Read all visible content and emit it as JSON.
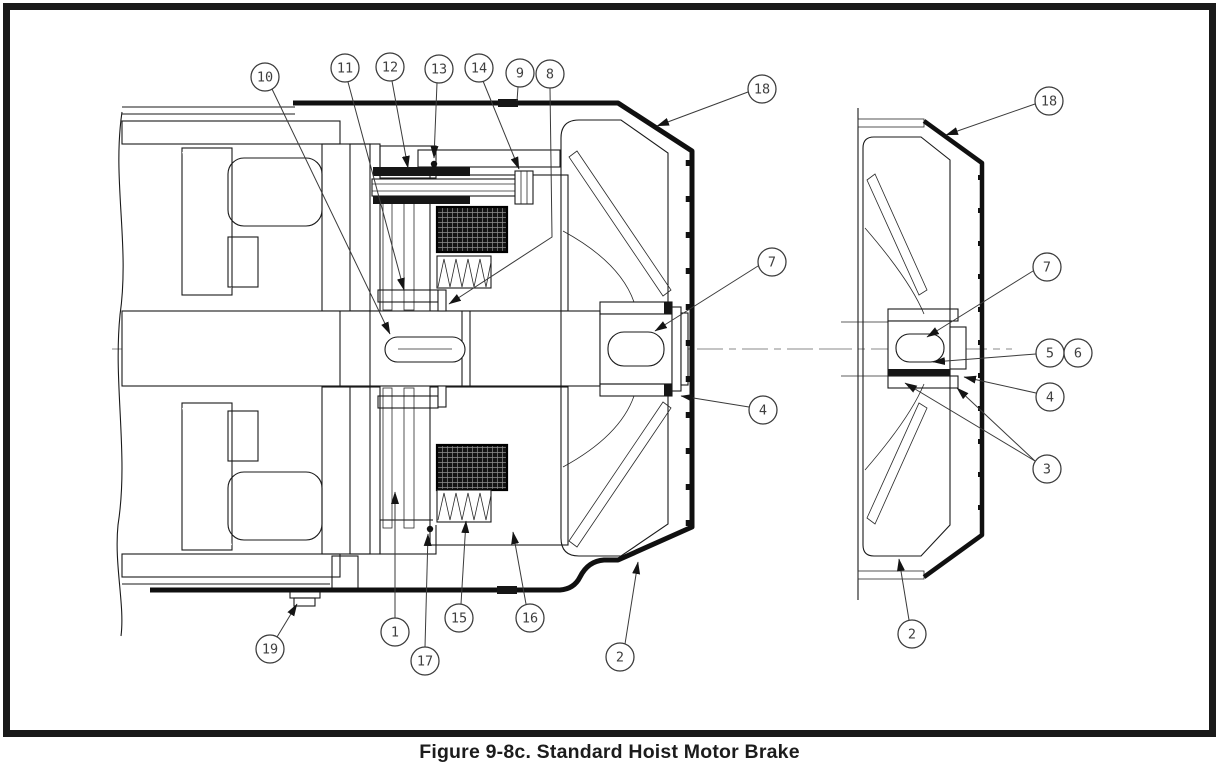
{
  "figure": {
    "caption": "Figure 9-8c. Standard Hoist Motor Brake",
    "figure_number": "9-8c",
    "title": "Standard Hoist Motor Brake",
    "views": [
      {
        "id": "main",
        "label": "Motor and brake sectional view"
      },
      {
        "id": "end",
        "label": "Brake wheel and fan end view"
      }
    ],
    "part_numbers_shown": [
      "1",
      "2",
      "3",
      "4",
      "5",
      "6",
      "7",
      "8",
      "9",
      "10",
      "11",
      "12",
      "13",
      "14",
      "15",
      "16",
      "17",
      "18",
      "19"
    ]
  },
  "colors": {
    "line": "#1a1a1a",
    "background": "#ffffff",
    "frame_border": "#1a1a1a",
    "centerline": "#8a8a8a",
    "balloon_stroke": "#3a3a3a",
    "coil_fill": "#141414"
  },
  "callouts": [
    {
      "label": "10",
      "view": "main",
      "cx": 265,
      "cy": 77,
      "leaders": [
        [
          [
            272,
            89
          ],
          [
            390,
            334
          ]
        ]
      ]
    },
    {
      "label": "11",
      "view": "main",
      "cx": 345,
      "cy": 68,
      "leaders": [
        [
          [
            348,
            82
          ],
          [
            404,
            290
          ]
        ]
      ]
    },
    {
      "label": "12",
      "view": "main",
      "cx": 390,
      "cy": 67,
      "leaders": [
        [
          [
            392,
            81
          ],
          [
            408,
            168
          ]
        ]
      ]
    },
    {
      "label": "13",
      "view": "main",
      "cx": 439,
      "cy": 69,
      "leaders": [
        [
          [
            437,
            83
          ],
          [
            434,
            158
          ]
        ]
      ],
      "dot": [
        434,
        164
      ]
    },
    {
      "label": "14",
      "view": "main",
      "cx": 479,
      "cy": 68,
      "leaders": [
        [
          [
            483,
            81
          ],
          [
            519,
            169
          ]
        ]
      ]
    },
    {
      "label": "9",
      "view": "main",
      "cx": 520,
      "cy": 73,
      "leaders": [
        [
          [
            518,
            87
          ],
          [
            517,
            101
          ]
        ]
      ],
      "plain": true
    },
    {
      "label": "8",
      "view": "main",
      "cx": 550,
      "cy": 74,
      "leaders": [
        [
          [
            550,
            88
          ],
          [
            552,
            237
          ],
          [
            449,
            304
          ]
        ]
      ]
    },
    {
      "label": "18",
      "view": "main",
      "cx": 762,
      "cy": 89,
      "leaders": [
        [
          [
            748,
            92
          ],
          [
            657,
            126
          ]
        ]
      ]
    },
    {
      "label": "7",
      "view": "main",
      "cx": 772,
      "cy": 262,
      "leaders": [
        [
          [
            758,
            266
          ],
          [
            655,
            331
          ]
        ]
      ]
    },
    {
      "label": "4",
      "view": "main",
      "cx": 763,
      "cy": 410,
      "leaders": [
        [
          [
            749,
            407
          ],
          [
            681,
            396
          ]
        ]
      ]
    },
    {
      "label": "19",
      "view": "main",
      "cx": 270,
      "cy": 649,
      "leaders": [
        [
          [
            277,
            637
          ],
          [
            297,
            604
          ]
        ]
      ]
    },
    {
      "label": "1",
      "view": "main",
      "cx": 395,
      "cy": 632,
      "leaders": [
        [
          [
            395,
            618
          ],
          [
            395,
            492
          ]
        ]
      ]
    },
    {
      "label": "17",
      "view": "main",
      "cx": 425,
      "cy": 661,
      "leaders": [
        [
          [
            425,
            647
          ],
          [
            428,
            534
          ]
        ]
      ],
      "dot": [
        430,
        529
      ]
    },
    {
      "label": "15",
      "view": "main",
      "cx": 459,
      "cy": 618,
      "leaders": [
        [
          [
            461,
            604
          ],
          [
            466,
            521
          ]
        ]
      ]
    },
    {
      "label": "16",
      "view": "main",
      "cx": 530,
      "cy": 618,
      "leaders": [
        [
          [
            526,
            604
          ],
          [
            513,
            532
          ]
        ]
      ]
    },
    {
      "label": "2",
      "view": "main",
      "cx": 620,
      "cy": 657,
      "leaders": [
        [
          [
            625,
            644
          ],
          [
            638,
            562
          ]
        ]
      ]
    },
    {
      "label": "18",
      "view": "end",
      "cx": 1049,
      "cy": 101,
      "leaders": [
        [
          [
            1035,
            104
          ],
          [
            946,
            135
          ]
        ]
      ]
    },
    {
      "label": "7",
      "view": "end",
      "cx": 1047,
      "cy": 267,
      "leaders": [
        [
          [
            1033,
            271
          ],
          [
            927,
            337
          ]
        ]
      ]
    },
    {
      "label": "5",
      "view": "end",
      "cx": 1050,
      "cy": 353,
      "leaders": [
        [
          [
            1036,
            354
          ],
          [
            933,
            362
          ]
        ]
      ]
    },
    {
      "label": "6",
      "view": "end",
      "cx": 1078,
      "cy": 353,
      "leaders": []
    },
    {
      "label": "4",
      "view": "end",
      "cx": 1050,
      "cy": 397,
      "leaders": [
        [
          [
            1036,
            393
          ],
          [
            964,
            377
          ]
        ]
      ]
    },
    {
      "label": "3",
      "view": "end",
      "cx": 1047,
      "cy": 469,
      "leaders": [
        [
          [
            1035,
            461
          ],
          [
            905,
            383
          ]
        ],
        [
          [
            1035,
            461
          ],
          [
            957,
            388
          ]
        ]
      ]
    },
    {
      "label": "2",
      "view": "end",
      "cx": 912,
      "cy": 634,
      "leaders": [
        [
          [
            909,
            620
          ],
          [
            899,
            559
          ]
        ]
      ]
    }
  ]
}
